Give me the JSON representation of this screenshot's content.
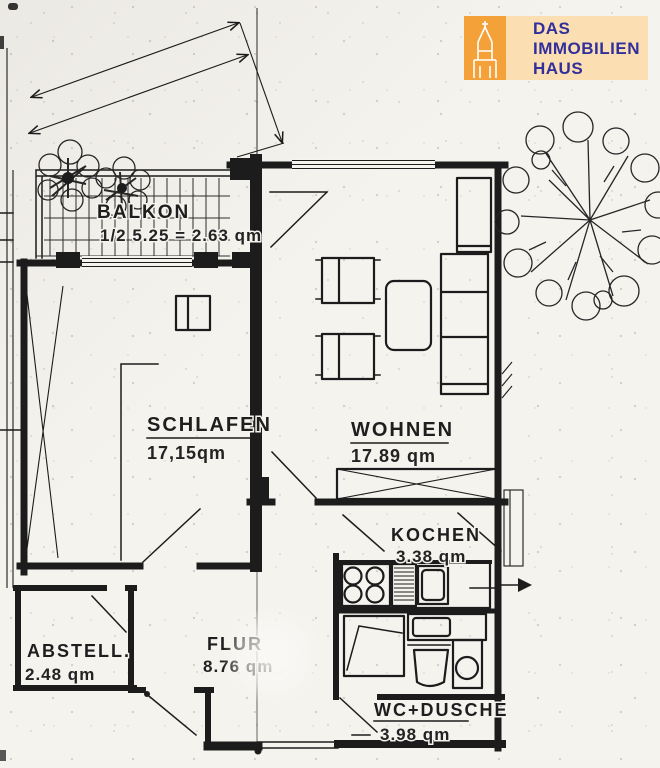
{
  "logo": {
    "line1": "DAS",
    "line2": "IMMOBILIEN",
    "line3": "HAUS",
    "icon": "church-tower-icon"
  },
  "rooms": [
    {
      "id": "balkon",
      "name": "BALKON",
      "area": "1/2 5.25 = 2.63 qm"
    },
    {
      "id": "schlafen",
      "name": "SCHLAFEN",
      "area": "17,15qm"
    },
    {
      "id": "wohnen",
      "name": "WOHNEN",
      "area": "17.89 qm"
    },
    {
      "id": "kochen",
      "name": "KOCHEN",
      "area": "3.38 qm"
    },
    {
      "id": "abstell",
      "name": "ABSTELL.",
      "area": "2.48 qm"
    },
    {
      "id": "flur",
      "name": "FLUR",
      "area": "8.76 qm"
    },
    {
      "id": "wc",
      "name": "WC+DUSCHE",
      "area": "3.98 qm"
    }
  ],
  "colors": {
    "ink": "#1c1c1c",
    "paper": "#f5f3ee",
    "logo_orange": "#f4a139",
    "logo_panel": "#fbdfb2",
    "logo_text": "#312f9b"
  }
}
